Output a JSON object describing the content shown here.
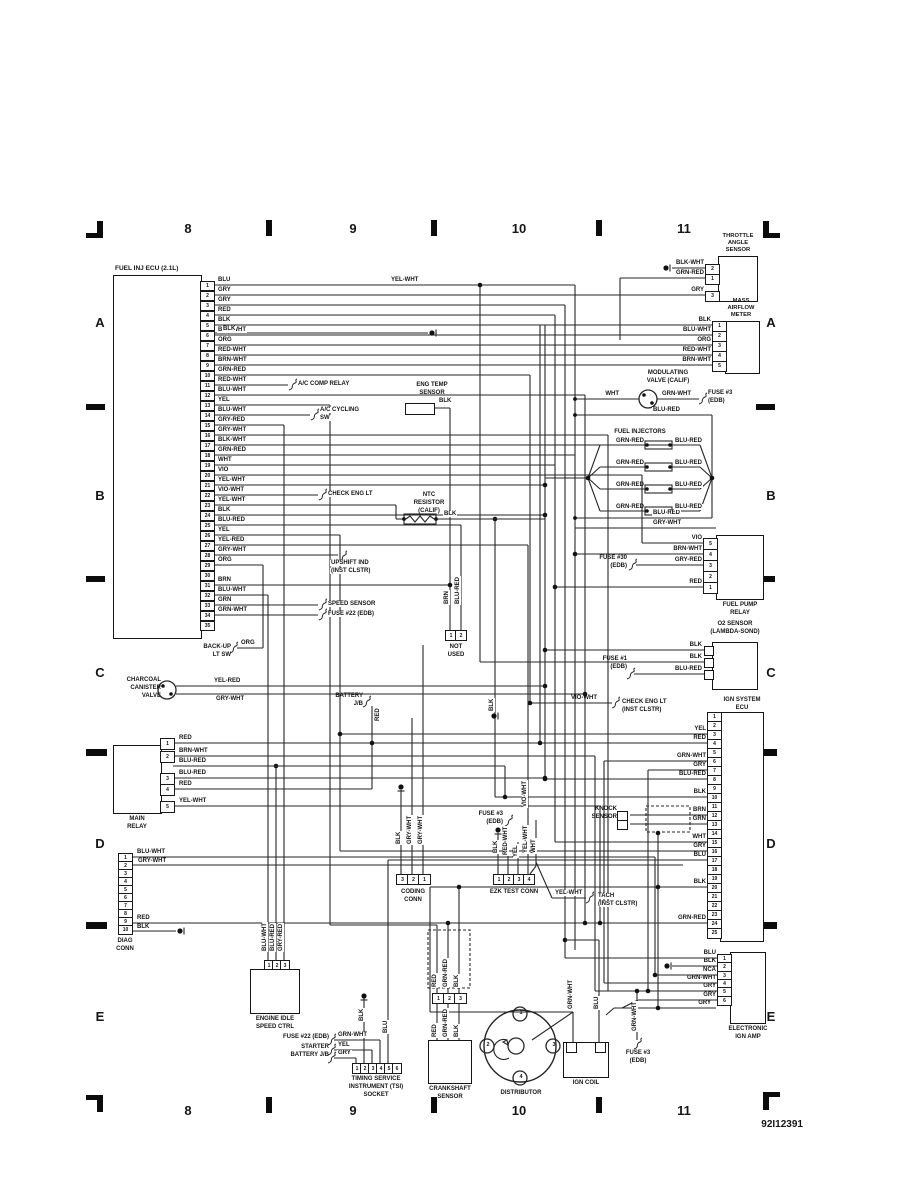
{
  "doc": {
    "id": "92I12391"
  },
  "grid": {
    "top": [
      "8",
      "9",
      "10",
      "11"
    ],
    "bottom": [
      "8",
      "9",
      "10",
      "11"
    ],
    "left": [
      "A",
      "B",
      "C",
      "D",
      "E"
    ],
    "right": [
      "A",
      "B",
      "C",
      "D",
      "E"
    ]
  },
  "labels": {
    "yel_wht_top": "YEL-WHT",
    "blk_p5b": "BLK",
    "ac_comp_relay": "A/C COMP RELAY",
    "ac_cycling_1": "A/C CYCLING",
    "ac_cycling_2": "SW",
    "check_eng_lt": "CHECK ENG LT",
    "upshift_1": "UPSHIFT IND",
    "upshift_2": "(INST CLSTR)",
    "speed_sensor": "SPEED SENSOR",
    "fuse22": "FUSE #22 (EDB)"
  },
  "ecu": {
    "title": "FUEL INJ ECU (2.1L)",
    "pins": [
      {
        "n": "1",
        "w": "BLU"
      },
      {
        "n": "2",
        "w": "GRY"
      },
      {
        "n": "3",
        "w": "GRY"
      },
      {
        "n": "4",
        "w": "RED"
      },
      {
        "n": "5",
        "w": "BLK"
      },
      {
        "n": "6",
        "w": "BLU-WHT"
      },
      {
        "n": "7",
        "w": "ORG"
      },
      {
        "n": "8",
        "w": "RED-WHT"
      },
      {
        "n": "9",
        "w": "BRN-WHT"
      },
      {
        "n": "10",
        "w": "GRN-RED"
      },
      {
        "n": "11",
        "w": "RED-WHT"
      },
      {
        "n": "12",
        "w": "BLU-WHT"
      },
      {
        "n": "13",
        "w": "YEL"
      },
      {
        "n": "14",
        "w": "BLU-WHT"
      },
      {
        "n": "15",
        "w": "GRY-RED"
      },
      {
        "n": "16",
        "w": "GRY-WHT"
      },
      {
        "n": "17",
        "w": "BLK-WHT"
      },
      {
        "n": "18",
        "w": "GRN-RED"
      },
      {
        "n": "19",
        "w": "WHT"
      },
      {
        "n": "20",
        "w": "VIO"
      },
      {
        "n": "21",
        "w": "YEL-WHT"
      },
      {
        "n": "22",
        "w": "VIO-WHT"
      },
      {
        "n": "23",
        "w": "YEL-WHT"
      },
      {
        "n": "24",
        "w": "BLK"
      },
      {
        "n": "25",
        "w": "BLU-RED"
      },
      {
        "n": "26",
        "w": "YEL"
      },
      {
        "n": "27",
        "w": "YEL-RED"
      },
      {
        "n": "28",
        "w": "GRY-WHT"
      },
      {
        "n": "29",
        "w": "ORG"
      },
      {
        "n": "30",
        "w": ""
      },
      {
        "n": "31",
        "w": "BRN"
      },
      {
        "n": "32",
        "w": "BLU-WHT"
      },
      {
        "n": "33",
        "w": "GRN"
      },
      {
        "n": "34",
        "w": "GRN-WHT"
      },
      {
        "n": "35",
        "w": ""
      }
    ]
  },
  "throttle": {
    "t1": "THROTTLE",
    "t2": "ANGLE",
    "t3": "SENSOR",
    "pins": [
      {
        "n": "2",
        "w": "BLK-WHT"
      },
      {
        "n": "1",
        "w": "GRN-RED"
      },
      {
        "n": "3",
        "w": "GRY"
      }
    ]
  },
  "maf": {
    "t1": "MASS",
    "t2": "AIRFLOW",
    "t3": "METER",
    "pins": [
      {
        "n": "1",
        "w": "BLK"
      },
      {
        "n": "2",
        "w": "BLU-WHT"
      },
      {
        "n": "3",
        "w": "ORG"
      },
      {
        "n": "4",
        "w": "RED-WHT"
      },
      {
        "n": "5",
        "w": "BRN-WHT"
      }
    ]
  },
  "mod": {
    "t1": "MODULATING",
    "t2": "VALVE (CALIF)",
    "wl": "WHT",
    "wr": "GRN-WHT",
    "f1": "FUSE #3",
    "f2": "(EDB)"
  },
  "inj": {
    "title": "FUEL INJECTORS",
    "l": "GRN-RED",
    "r": "BLU-RED",
    "top": "BLU-RED",
    "bottom": "BLU-RED",
    "grywht": "GRY-WHT"
  },
  "fp": {
    "t1": "FUEL PUMP",
    "t2": "RELAY",
    "f1": "FUSE #30",
    "f2": "(EDB)",
    "pins": [
      {
        "n": "5",
        "w": "VIO"
      },
      {
        "n": "4",
        "w": "BRN-WHT"
      },
      {
        "n": "3",
        "w": "GRY-RED"
      },
      {
        "n": "2",
        "w": ""
      },
      {
        "n": "1",
        "w": "RED"
      }
    ]
  },
  "o2": {
    "t1": "O2 SENSOR",
    "t2": "(LAMBDA-SOND)",
    "w1": "BLK",
    "w2": "BLK",
    "w3": "BLU-RED",
    "f1": "FUSE #1",
    "f2": "(EDB)"
  },
  "checkinst": {
    "w": "VIO-WHT",
    "l1": "CHECK ENG LT",
    "l2": "(INST CLSTR)",
    "gnd": "BLK"
  },
  "ignecu": {
    "t1": "IGN SYSTEM",
    "t2": "ECU",
    "pins": [
      {
        "n": "1",
        "w": ""
      },
      {
        "n": "2",
        "w": ""
      },
      {
        "n": "3",
        "w": "YEL"
      },
      {
        "n": "4",
        "w": "RED"
      },
      {
        "n": "5",
        "w": ""
      },
      {
        "n": "6",
        "w": "GRN-WHT"
      },
      {
        "n": "7",
        "w": "GRY"
      },
      {
        "n": "8",
        "w": "BLU-RED"
      },
      {
        "n": "9",
        "w": ""
      },
      {
        "n": "10",
        "w": "BLK"
      },
      {
        "n": "11",
        "w": ""
      },
      {
        "n": "12",
        "w": "BRN"
      },
      {
        "n": "13",
        "w": "GRN"
      },
      {
        "n": "14",
        "w": ""
      },
      {
        "n": "15",
        "w": "WHT"
      },
      {
        "n": "16",
        "w": "GRY"
      },
      {
        "n": "17",
        "w": "BLU"
      },
      {
        "n": "18",
        "w": ""
      },
      {
        "n": "19",
        "w": ""
      },
      {
        "n": "20",
        "w": "BLK"
      },
      {
        "n": "21",
        "w": ""
      },
      {
        "n": "22",
        "w": ""
      },
      {
        "n": "23",
        "w": ""
      },
      {
        "n": "24",
        "w": "GRN-RED"
      },
      {
        "n": "25",
        "w": ""
      }
    ]
  },
  "knock": {
    "t1": "KNOCK",
    "t2": "SENSOR"
  },
  "amp": {
    "t1": "ELECTRONIC",
    "t2": "IGN AMP",
    "extra": "GRY",
    "pins": [
      {
        "n": "1",
        "w": "BLU"
      },
      {
        "n": "2",
        "w": "BLK"
      },
      {
        "n": "3",
        "w": "NCA"
      },
      {
        "n": "4",
        "w": "GRN-WHT"
      },
      {
        "n": "5",
        "w": "GRY"
      },
      {
        "n": "6",
        "w": "GRY"
      }
    ]
  },
  "main": {
    "t1": "MAIN",
    "t2": "RELAY",
    "pins": [
      "1",
      "2",
      "3",
      "4",
      "5"
    ],
    "wires": [
      "RED",
      "BRN-WHT",
      "BLU-RED",
      "BLU-RED",
      "RED",
      "YEL-WHT"
    ]
  },
  "charcoal": {
    "t1": "CHARCOAL",
    "t2": "CANISTER",
    "t3": "VALVE",
    "w1": "YEL-RED",
    "w2": "GRY-WHT"
  },
  "battery": {
    "t1": "BATTERY",
    "t2": "J/B",
    "w": "RED"
  },
  "backup": {
    "t1": "BACK-UP",
    "t2": "LT SW",
    "w": "ORG"
  },
  "diag": {
    "t1": "DIAG",
    "t2": "CONN",
    "pins": [
      {
        "n": "1",
        "w": "BLU-WHT"
      },
      {
        "n": "2",
        "w": "GRY-WHT"
      },
      {
        "n": "3",
        "w": ""
      },
      {
        "n": "4",
        "w": ""
      },
      {
        "n": "5",
        "w": ""
      },
      {
        "n": "6",
        "w": ""
      },
      {
        "n": "7",
        "w": ""
      },
      {
        "n": "8",
        "w": ""
      },
      {
        "n": "9",
        "w": "RED"
      },
      {
        "n": "10",
        "w": "BLK"
      }
    ]
  },
  "idle": {
    "t1": "ENGINE IDLE",
    "t2": "SPEED CTRL",
    "pins": [
      "1",
      "2",
      "3"
    ],
    "wires": [
      "BLU-WHT",
      "BLU-RED",
      "GRY-RED"
    ]
  },
  "tsi": {
    "t1": "TIMING SERVICE",
    "t2": "INSTRUMENT (TSI)",
    "t3": "SOCKET",
    "pins": [
      "1",
      "2",
      "3",
      "4",
      "5",
      "6"
    ],
    "ref1": "FUSE #22 (EDB)",
    "ref2": "STARTER",
    "ref3": "BATTERY J/B",
    "rw1": "GRN-WHT",
    "rw2": "YEL",
    "rw3": "GRY",
    "v1": "BLK",
    "v2": "BLU"
  },
  "coding": {
    "t1": "CODING",
    "t2": "CONN",
    "pins": [
      "3",
      "2",
      "1"
    ],
    "wires": [
      "BLK",
      "GRY-WHT",
      "GRY-WHT"
    ]
  },
  "ezk": {
    "title": "EZK TEST CONN",
    "pins": [
      "1",
      "2",
      "3",
      "4"
    ],
    "wires": [
      "BLK",
      "RED-WHT",
      "YEL",
      "YEL-WHT",
      "WHT"
    ],
    "vio": "VIO-WHT",
    "f1": "FUSE #3",
    "f2": "(EDB)",
    "tach_w": "YEL-WHT",
    "tach1": "TACH",
    "tach2": "(INST CLSTR)"
  },
  "crank": {
    "t1": "CRANKSHAFT",
    "t2": "SENSOR",
    "pins": [
      "1",
      "2",
      "3"
    ],
    "wires": [
      "RED",
      "GRN-RED",
      "BLK"
    ]
  },
  "dist": {
    "title": "DISTRIBUTOR",
    "terminals": [
      "1",
      "2",
      "3",
      "4"
    ]
  },
  "coil": {
    "title": "IGN COIL",
    "w1": "GRN-WHT",
    "w2": "BLU"
  },
  "fuse3b": {
    "f1": "FUSE #3",
    "f2": "(EDB)",
    "w": "GRN-WHT"
  },
  "notused": {
    "t1": "NOT",
    "t2": "USED",
    "pins": [
      "1",
      "2"
    ],
    "wires": [
      "BRN",
      "BLU-RED"
    ]
  },
  "engtemp": {
    "t1": "ENG TEMP",
    "t2": "SENSOR",
    "w": "BLK"
  },
  "ntc": {
    "t1": "NTC",
    "t2": "RESISTOR",
    "t3": "(CALIF)",
    "w": "BLK"
  }
}
